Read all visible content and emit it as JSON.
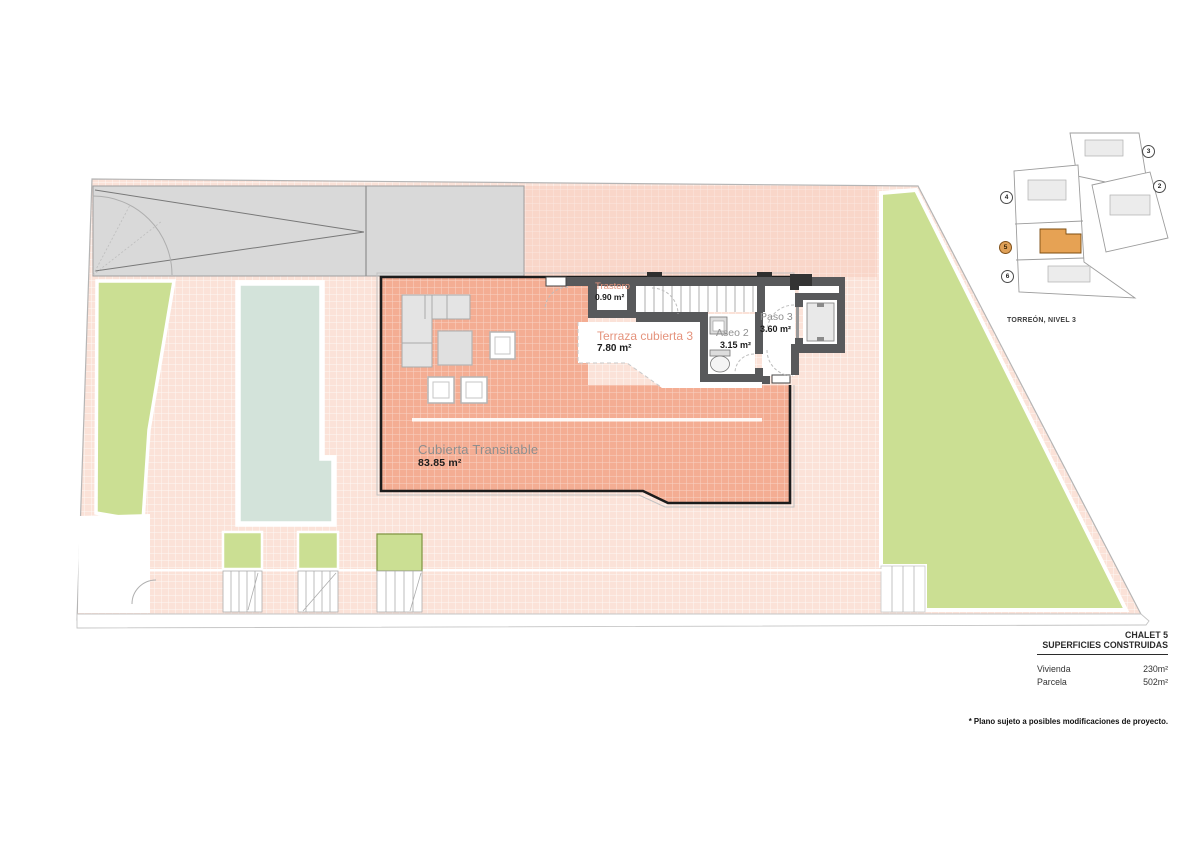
{
  "plan": {
    "rooms": [
      {
        "name": "Trastero",
        "area": "0.90 m²"
      },
      {
        "name": "Terraza cubierta 3",
        "area": "7.80 m²"
      },
      {
        "name": "Aseo 2",
        "area": "3.15 m²"
      },
      {
        "name": "Paso 3",
        "area": "3.60 m²"
      },
      {
        "name": "Cubierta Transitable",
        "area": "83.85 m²"
      }
    ]
  },
  "key_plan": {
    "caption": "TORREÓN, NIVEL 3",
    "highlighted_unit": "5",
    "units": [
      {
        "label": "3"
      },
      {
        "label": "2"
      },
      {
        "label": "4"
      },
      {
        "label": "5"
      },
      {
        "label": "6"
      }
    ]
  },
  "legend": {
    "title": "CHALET 5",
    "subtitle": "SUPERFICIES CONSTRUIDAS",
    "rows": [
      {
        "label": "Vivienda",
        "value": "230m²"
      },
      {
        "label": "Parcela",
        "value": "502m²"
      }
    ]
  },
  "footnote": "* Plano sujeto a posibles modificaciones de proyecto.",
  "colors": {
    "plot_pink": "#fbe2d8",
    "terrace_salmon": "#f4ad93",
    "garden_green": "#cbdf93",
    "pool_teal": "#d3e3da",
    "driveway_gray": "#d9d9d9",
    "wall_gray": "#58595b",
    "highlight_orange": "#e6a254",
    "label_salmon": "#e5937c",
    "label_gray": "#8f8f8f"
  }
}
